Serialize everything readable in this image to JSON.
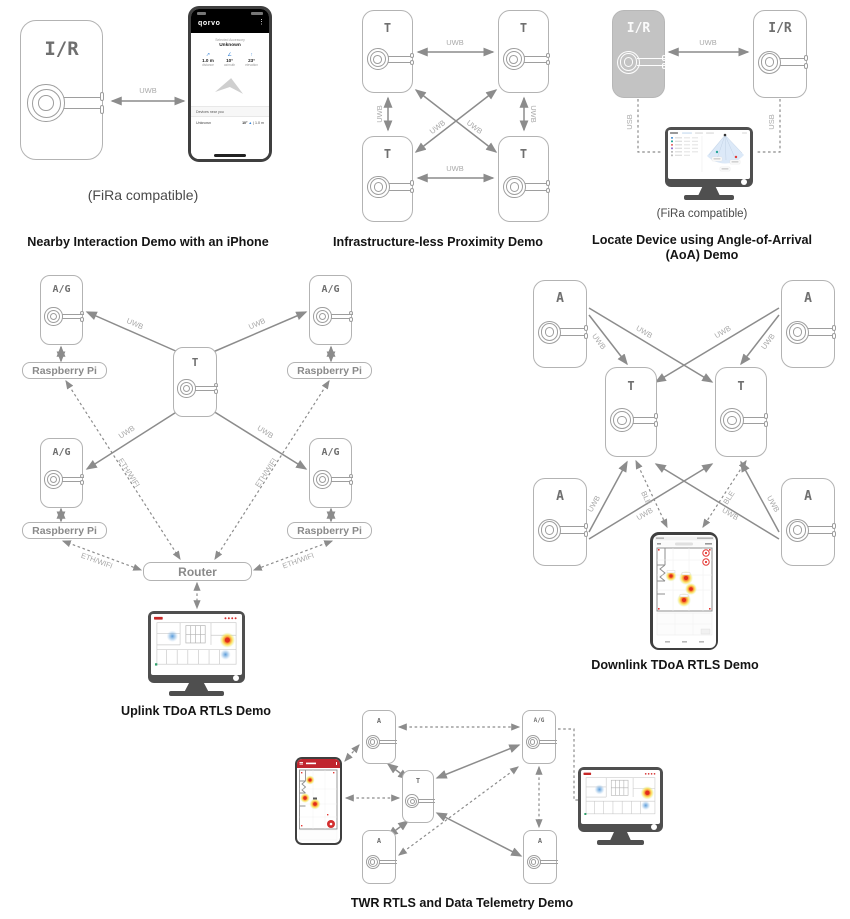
{
  "labels": {
    "uwb": "UWB",
    "usb": "USB",
    "eth_wifi": "ETH/WIFI",
    "ble": "BLE"
  },
  "devices": {
    "initiator_responder": "I/R",
    "tag": "T",
    "anchor": "A",
    "anchor_gateway": "A/G",
    "raspberry_pi": "Raspberry Pi",
    "router": "Router"
  },
  "captions": {
    "nearby": "Nearby Interaction Demo with an iPhone",
    "proximity": "Infrastructure-less Proximity Demo",
    "aoa_line1": "Locate Device using Angle-of-Arrival",
    "aoa_line2": "(AoA) Demo",
    "uplink": "Uplink TDoA RTLS Demo",
    "downlink": "Downlink TDoA RTLS Demo",
    "twr": "TWR RTLS and Data Telemetry Demo",
    "fira": "(FiRa compatible)"
  },
  "phone_app": {
    "brand": "qorvo",
    "selected_accessory_label": "Selected Accessory",
    "accessory_name": "Unknown",
    "stats": [
      {
        "value": "1.0 m",
        "label": "distance"
      },
      {
        "value": "10°",
        "label": "azimuth"
      },
      {
        "value": "23°",
        "label": "elevation"
      }
    ],
    "section_title": "Devices near you",
    "device_row": {
      "name": "Unknown",
      "angle": "10°",
      "distance": "1.0 m"
    }
  },
  "icons": {
    "kebab_menu": "⋮",
    "up_arrow": "▲",
    "divider": "|",
    "distance_icon": "↗",
    "azimuth_icon": "∠",
    "elevation_icon": "↑"
  },
  "colors": {
    "device_border": "#b3b3b3",
    "device_label": "#6f6f6f",
    "arrow_gray": "#8c8c8c",
    "accent_blue": "#2f7fd6",
    "heat_red": "#e02c1e",
    "heat_orange": "#f57f17",
    "app_red": "#c0252e",
    "monitor_gray": "#4f4f4f",
    "fan_blue": "#dce9f8"
  }
}
